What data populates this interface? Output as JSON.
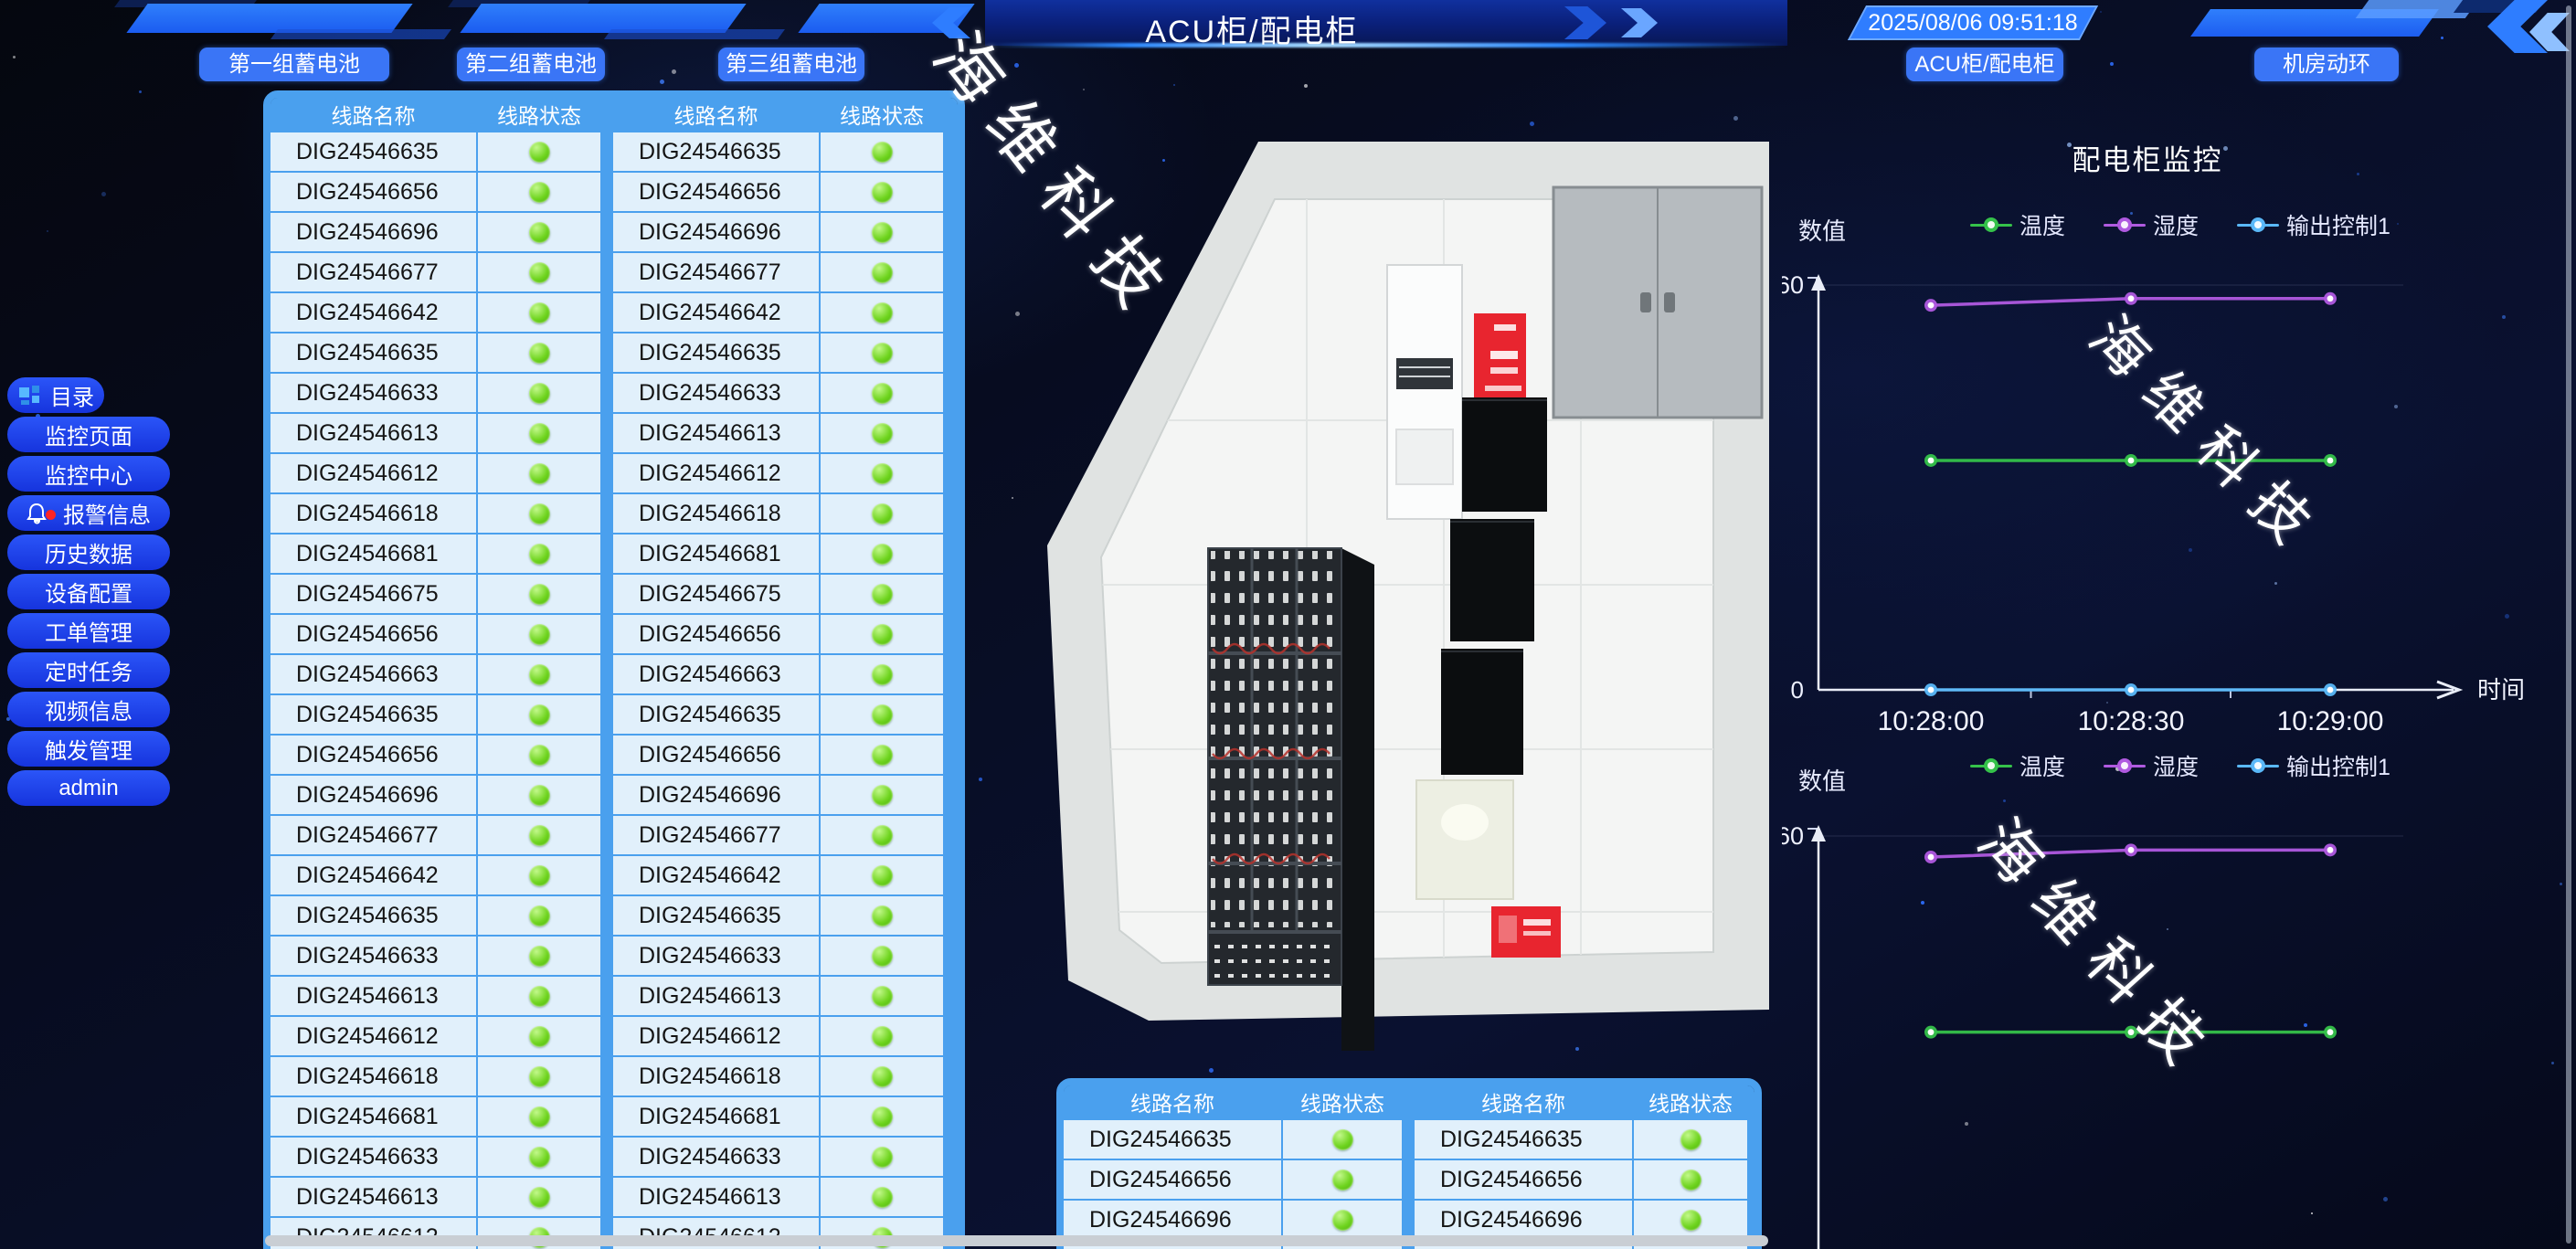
{
  "topbar": {
    "title": "ACU柜/配电柜",
    "timestamp": "2025/08/06 09:51:18"
  },
  "group_buttons": [
    "第一组蓄电池",
    "第二组蓄电池",
    "第三组蓄电池"
  ],
  "nav_buttons": [
    "ACU柜/配电柜",
    "机房动环"
  ],
  "sidebar": {
    "items": [
      {
        "label": "目录",
        "icon": "menu-grid-icon"
      },
      {
        "label": "监控页面",
        "icon": ""
      },
      {
        "label": "监控中心",
        "icon": ""
      },
      {
        "label": "报警信息",
        "icon": "bell-icon",
        "alert_badge": true
      },
      {
        "label": "历史数据",
        "icon": ""
      },
      {
        "label": "设备配置",
        "icon": ""
      },
      {
        "label": "工单管理",
        "icon": ""
      },
      {
        "label": "定时任务",
        "icon": ""
      },
      {
        "label": "视频信息",
        "icon": ""
      },
      {
        "label": "触发管理",
        "icon": ""
      },
      {
        "label": "admin",
        "icon": ""
      }
    ]
  },
  "tables": {
    "headers": [
      "线路名称",
      "线路状态",
      "线路名称",
      "线路状态"
    ],
    "status": "ok",
    "main_rows": [
      "DIG24546635",
      "DIG24546656",
      "DIG24546696",
      "DIG24546677",
      "DIG24546642",
      "DIG24546635",
      "DIG24546633",
      "DIG24546613",
      "DIG24546612",
      "DIG24546618",
      "DIG24546681",
      "DIG24546675",
      "DIG24546656",
      "DIG24546663",
      "DIG24546635",
      "DIG24546656",
      "DIG24546696",
      "DIG24546677",
      "DIG24546642",
      "DIG24546635",
      "DIG24546633",
      "DIG24546613",
      "DIG24546612",
      "DIG24546618",
      "DIG24546681",
      "DIG24546633",
      "DIG24546613",
      "DIG24546612"
    ],
    "bottom_rows": [
      "DIG24546635",
      "DIG24546656",
      "DIG24546696",
      "DIG24546677"
    ]
  },
  "watermark": "海维科技",
  "chart_data": [
    {
      "type": "line",
      "title": "配电柜监控",
      "x": [
        "10:28:00",
        "10:28:30",
        "10:29:00"
      ],
      "xlabel": "时间",
      "ylabel": "数值",
      "ylim": [
        0,
        60
      ],
      "yticks": [
        0,
        60
      ],
      "grid": false,
      "legend_position": "top",
      "xaxis_visible": true,
      "series": [
        {
          "name": "温度",
          "color": "#35c24a",
          "values": [
            34,
            34,
            34
          ]
        },
        {
          "name": "湿度",
          "color": "#b05ae0",
          "values": [
            57,
            58,
            58
          ]
        },
        {
          "name": "输出控制1",
          "color": "#5ab8f8",
          "values": [
            0,
            0,
            0
          ]
        }
      ]
    },
    {
      "type": "line",
      "title": "",
      "x": [
        "10:28:00",
        "10:28:30",
        "10:29:00"
      ],
      "xlabel": "时间",
      "ylabel": "数值",
      "ylim": [
        0,
        60
      ],
      "yticks": [
        60
      ],
      "grid": false,
      "legend_position": "top",
      "xaxis_visible": false,
      "series": [
        {
          "name": "温度",
          "color": "#35c24a",
          "values": [
            32,
            32,
            32
          ]
        },
        {
          "name": "湿度",
          "color": "#b05ae0",
          "values": [
            57,
            58,
            58
          ]
        },
        {
          "name": "输出控制1",
          "color": "#5ab8f8",
          "values": [
            0,
            0,
            0
          ]
        }
      ]
    }
  ],
  "colors": {
    "accent_blue": "#2e7dff",
    "pill_blue": "#1d43ee",
    "table_header_blue": "#4aa0ee",
    "row_bg": "#e1f0fb",
    "status_green": "#55c414"
  }
}
